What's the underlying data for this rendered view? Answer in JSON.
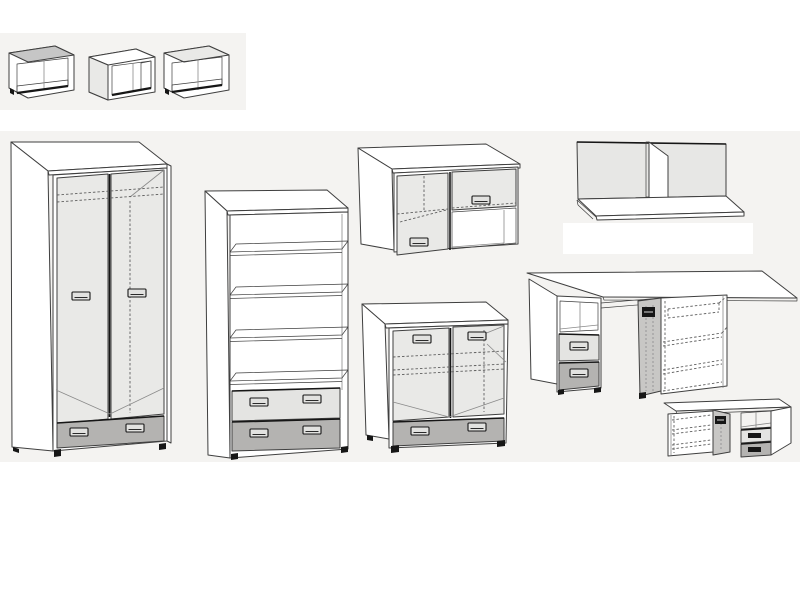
{
  "page": {
    "kind": "furniture line-drawing catalog sheet",
    "background": "#ffffff",
    "band_color": "#f4f3f1"
  },
  "palette": {
    "page_bg": "#ffffff",
    "band": "#f4f3f1",
    "panel_white": "#ffffff",
    "outline": "#3f3f3f",
    "outline_dark": "#161616",
    "door_gray": "#e9e9e7",
    "drawer_light": "#e4e4e2",
    "drawer_mid": "#b4b3b1",
    "open_door": "#c8c7c5",
    "cube_top": "#c6c6c6",
    "interior_floor": "#d9d9d7",
    "back_panel": "#e7e7e5",
    "thin_line": "#8a8a8a",
    "dashed": "#5f5f5f",
    "handle_fill": "#e2e2e0"
  },
  "items": [
    {
      "name": "wall cube shelf variant 1"
    },
    {
      "name": "wall cube shelf variant 2"
    },
    {
      "name": "wall cube shelf variant 3"
    },
    {
      "name": "two-door wardrobe with bottom drawer"
    },
    {
      "name": "open bookcase with two bottom drawers"
    },
    {
      "name": "wall cabinet with sliding doors"
    },
    {
      "name": "two-door chest with bottom drawer"
    },
    {
      "name": "wall shelf with center divider"
    },
    {
      "name": "desk with drawer pedestal and open-door cabinet"
    },
    {
      "name": "compact desk with cabinet and drawer pedestal"
    }
  ]
}
